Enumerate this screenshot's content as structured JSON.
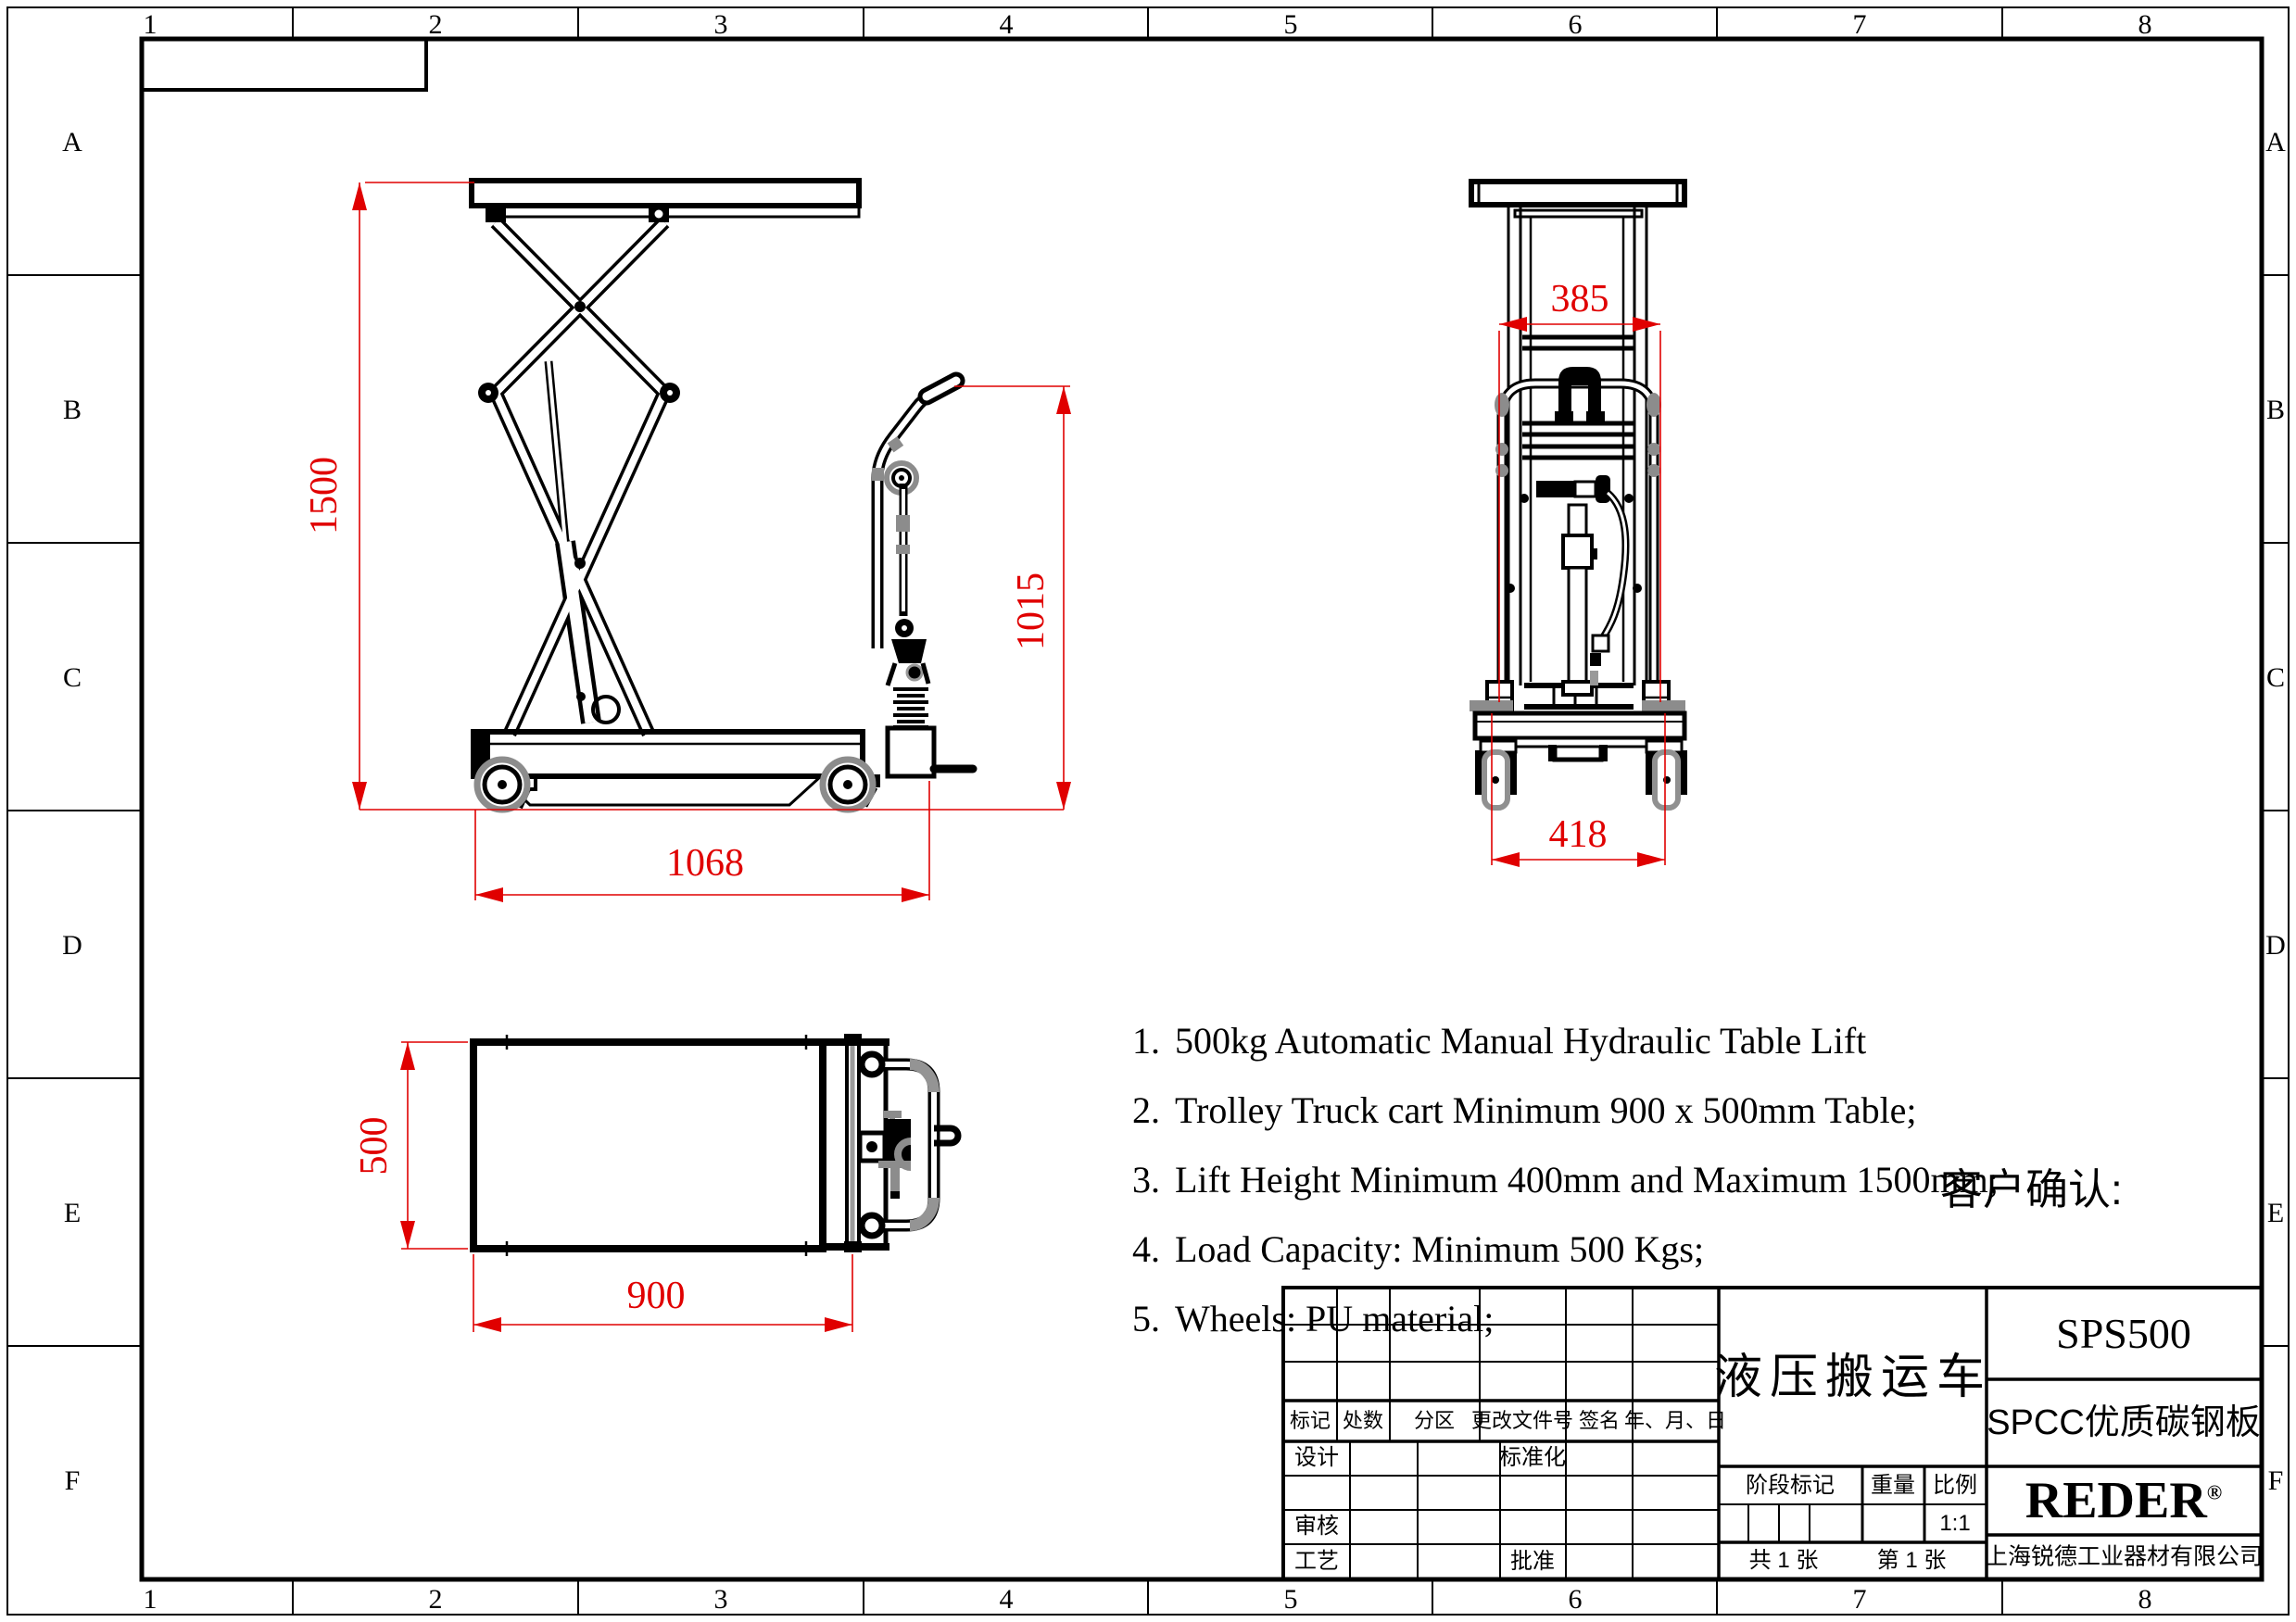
{
  "grid": {
    "cols": [
      "1",
      "2",
      "3",
      "4",
      "5",
      "6",
      "7",
      "8"
    ],
    "rows": [
      "A",
      "B",
      "C",
      "D",
      "E",
      "F"
    ]
  },
  "views": {
    "side": {
      "dims": {
        "lift_height_max": "1500",
        "base_length": "1068",
        "handle_height": "1015"
      }
    },
    "front": {
      "dims": {
        "mast_width": "385",
        "base_width": "418"
      }
    },
    "top": {
      "dims": {
        "table_width": "500",
        "table_length": "900"
      }
    }
  },
  "notes": {
    "items": [
      {
        "num": "1.",
        "text": "500kg Automatic Manual Hydraulic Table Lift"
      },
      {
        "num": "2.",
        "text": "Trolley Truck cart Minimum 900 x 500mm Table;"
      },
      {
        "num": "3.",
        "text": "Lift Height Minimum 400mm and Maximum 1500mm;"
      },
      {
        "num": "4.",
        "text": "Load Capacity: Minimum 500 Kgs;"
      },
      {
        "num": "5.",
        "text": "Wheels: PU material;"
      }
    ]
  },
  "customer_confirm": "客户确认:",
  "title_block": {
    "revision_header": {
      "mark": "标记",
      "count": "处数",
      "zone": "分区",
      "change_doc_no": "更改文件号",
      "signature": "签名",
      "date": "年、月、日"
    },
    "approval": {
      "design": "设计",
      "standardization": "标准化",
      "review": "审核",
      "process": "工艺",
      "approve": "批准"
    },
    "product_name": "液压搬运车",
    "stage_mark": "阶段标记",
    "weight": "重量",
    "scale_label": "比例",
    "scale_value": "1:1",
    "sheet_total": "共 1 张",
    "sheet_no": "第 1 张",
    "model": "SPS500",
    "material": "SPCC优质碳钢板",
    "brand": "REDER",
    "brand_reg": "®",
    "company": "上海锐德工业器材有限公司"
  },
  "colors": {
    "line": "#000000",
    "dimension": "#e00000",
    "tube_gray": "#8c8c8c"
  }
}
